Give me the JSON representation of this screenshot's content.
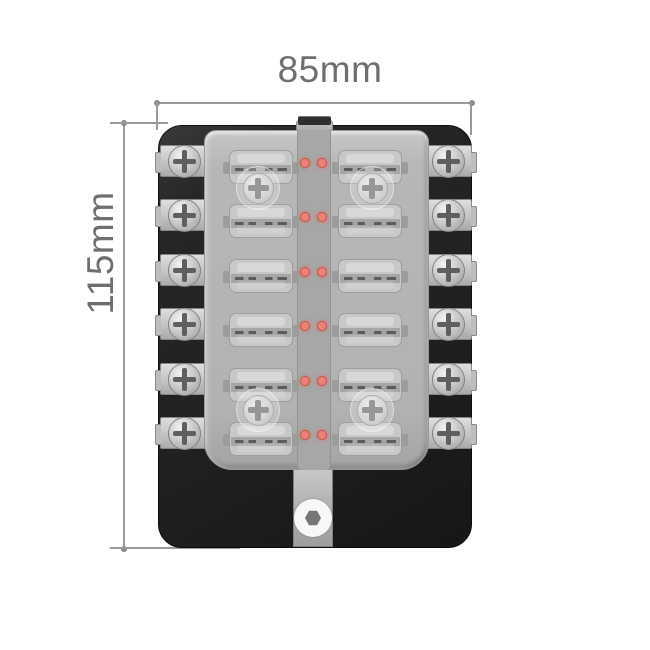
{
  "diagram": {
    "type": "product dimension diagram",
    "subject": "12-way blade fuse box with transparent cover, side screw terminals and LED indicators (top view)",
    "dimensions": {
      "width_label": "85mm",
      "height_label": "115mm"
    }
  },
  "product": {
    "fuse_rows": 6,
    "fuse_columns": 2,
    "fuse_count": 12,
    "terminals_per_side": 6,
    "terminal_count": 12,
    "leds_per_row": 2,
    "led_count": 12,
    "cover_screws": 4,
    "mounting_holes": 1
  },
  "icons": {
    "terminal_screw": "phillips-screw-icon",
    "cover_screw": "phillips-screw-icon",
    "led": "led-indicator-dot",
    "mounting_hole": "hex-nut-hole"
  },
  "colors": {
    "background": "#ffffff",
    "dimension_line": "#9a9a9a",
    "dimension_text": "#6f6f6f",
    "body": "#212121",
    "cover": "#b7b7b7",
    "led_channel": "#a7a7a7",
    "fuse": "#c8c8c8",
    "fuse_band": "#a6a6a6",
    "fuse_marking": "#5c5c5c",
    "terminal_plate": "#c9c9c9",
    "screw_slot": "#5f5f5f",
    "cover_screw_slot": "#979797",
    "led": "#ec8175",
    "led_border": "#c2564a",
    "mount_tab": "#b5b5b5",
    "mount_ring": "#f7f7f7",
    "mount_nut": "#767676",
    "latch_clip": "#2e2e2e"
  }
}
